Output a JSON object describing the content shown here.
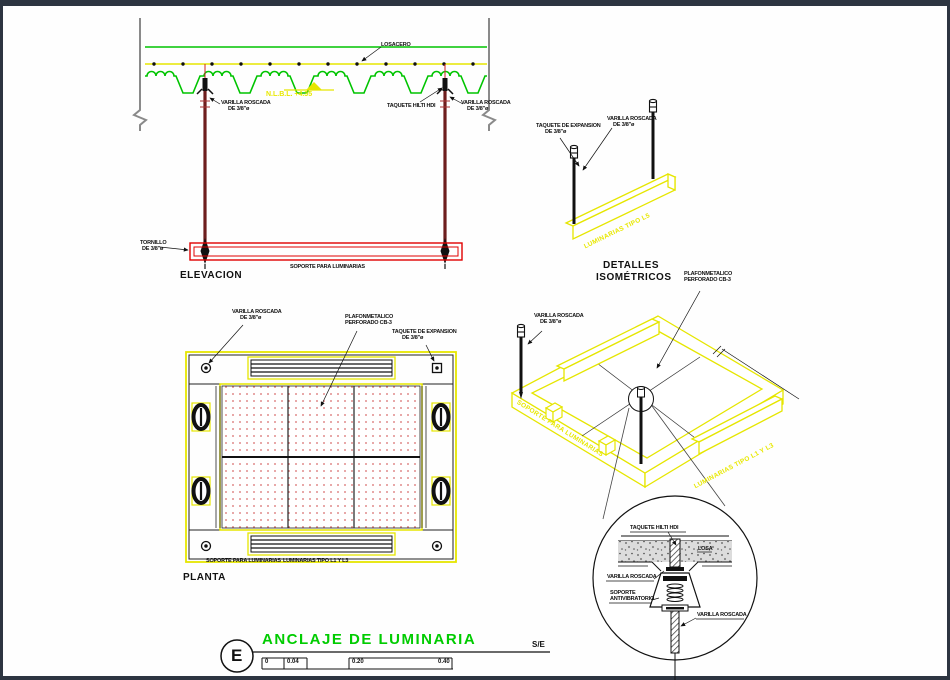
{
  "colors": {
    "green": "#00c400",
    "yellow": "#e6e600",
    "red": "#e00000",
    "dark_red": "#6e1e1e",
    "border_navy": "#2d3541",
    "dot_red": "#d86a6a",
    "title_green": "#00cc00"
  },
  "elevation": {
    "title": "ELEVACION",
    "losacero": "LOSACERO",
    "varilla_left_1": "VARILLA ROSCADA",
    "varilla_left_2": "DE 3/8\"ø",
    "level": "N.L.B.L.  +4.35",
    "taquete_hilti": "TAQUETE HILTI HDI",
    "varilla_right_1": "VARILLA ROSCADA",
    "varilla_right_2": "DE 3/8\"ø",
    "tornillo_1": "TORNILLO",
    "tornillo_2": "DE 3/8\"ø",
    "soporte": "SOPORTE PARA LUMINARIAS"
  },
  "iso_detail": {
    "title_1": "DETALLES",
    "title_2": "ISOMÉTRICOS",
    "taquete_1": "TAQUETE DE EXPANSION",
    "taquete_2": "DE 3/8\"ø",
    "varilla_1": "VARILLA ROSCADA",
    "varilla_2": "DE 3/8\"ø",
    "bar_text": "LUMINARIAS TIPO L5"
  },
  "planta": {
    "title": "PLANTA",
    "varilla_1": "VARILLA ROSCADA",
    "varilla_2": "DE 3/8\"ø",
    "plafon_1": "PLAFONMETALICO",
    "plafon_2": "PERFORADO CB-3",
    "taquete_1": "TAQUETE DE EXPANSION",
    "taquete_2": "DE 3/8\"ø",
    "soporte": "SOPORTE PARA LUMINARIAS",
    "luminarias": "LUMINARIAS TIPO L1 Y L3"
  },
  "iso_frame": {
    "varilla_1": "VARILLA ROSCADA",
    "varilla_2": "DE 3/8\"ø",
    "plafon_1": "PLAFONMETALICO",
    "plafon_2": "PERFORADO CB-3",
    "soporte_text": "SOPORTE PARA LUMINARIAS",
    "luminarias_text": "LUMINARIAS TIPO L1 Y L3"
  },
  "detail": {
    "taquete_hilti": "TAQUETE HILTI HDI",
    "losa": "LOSA",
    "varilla_a": "VARILLA ROSCADA",
    "soporte_1": "SOPORTE",
    "soporte_2": "ANTIVIBRATORIO",
    "varilla_b": "VARILLA ROSCADA"
  },
  "titleblock": {
    "letter": "E",
    "title": "ANCLAJE DE LUMINARIA",
    "scale": "S/E",
    "ticks": [
      "0",
      "0.04",
      "0.20",
      "0.40"
    ]
  }
}
